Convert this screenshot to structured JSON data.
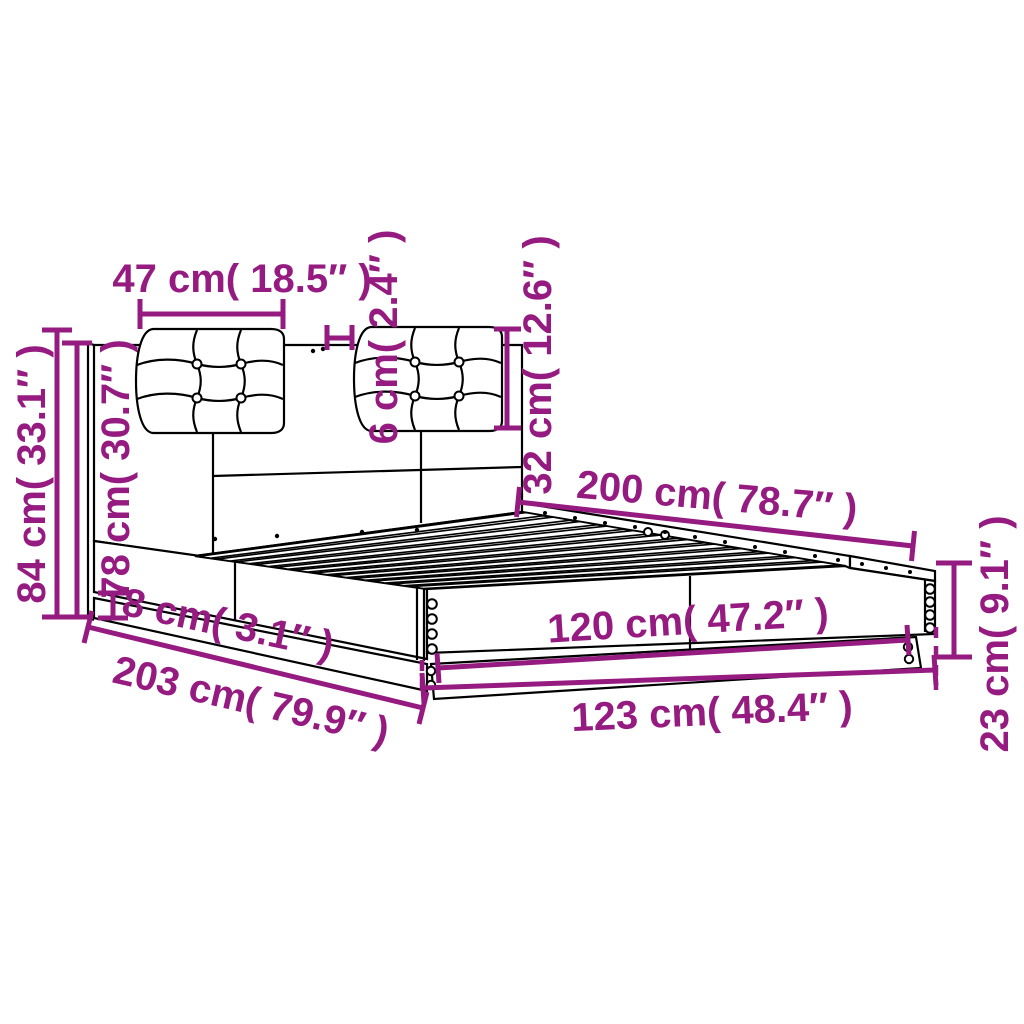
{
  "diagram": {
    "kind": "bed frame with headboard cushions - dimension drawing",
    "background": "#FFFFFF",
    "line_color": "#000000",
    "dimension_color": "#951B81",
    "dimensions": [
      {
        "id": "cushion-width",
        "label": "47 cm( 18.5″ )"
      },
      {
        "id": "total-height",
        "label": "84 cm( 33.1″ )"
      },
      {
        "id": "headboard-height",
        "label": "78 cm( 30.7″ )"
      },
      {
        "id": "cushion-thickness",
        "label": "6 cm( 2.4″ )"
      },
      {
        "id": "cushion-height",
        "label": "32 cm( 12.6″ )"
      },
      {
        "id": "bed-length",
        "label": "200 cm( 78.7″ )"
      },
      {
        "id": "frame-height",
        "label": "23 cm( 9.1″ )"
      },
      {
        "id": "mattress-width",
        "label": "120 cm( 47.2″ )"
      },
      {
        "id": "outer-width",
        "label": "123 cm( 48.4″ )"
      },
      {
        "id": "plinth-height",
        "label": "8 cm( 3.1″ )"
      },
      {
        "id": "outer-length",
        "label": "203 cm( 79.9″ )"
      }
    ]
  }
}
